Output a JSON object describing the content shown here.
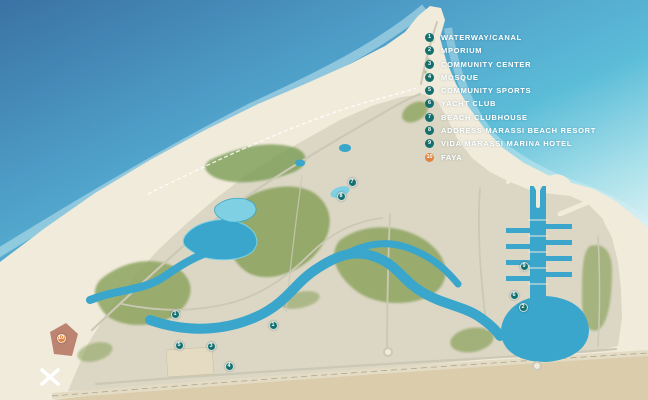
{
  "app": {
    "name": "marassi-master-plan-map"
  },
  "legend": {
    "items": [
      {
        "number": "1",
        "label": "WATERWAY/CANAL"
      },
      {
        "number": "2",
        "label": "MPORIUM"
      },
      {
        "number": "3",
        "label": "COMMUNITY CENTER"
      },
      {
        "number": "4",
        "label": "MOSQUE"
      },
      {
        "number": "5",
        "label": "COMMUNITY SPORTS"
      },
      {
        "number": "6",
        "label": "YACHT CLUB"
      },
      {
        "number": "7",
        "label": "BEACH CLUBHOUSE"
      },
      {
        "number": "8",
        "label": "ADDRESS MARASSI BEACH RESORT"
      },
      {
        "number": "9",
        "label": "VIDA MARASSI MARINA HOTEL"
      },
      {
        "number": "10",
        "label": "FAYA",
        "accent": true
      }
    ]
  },
  "map": {
    "markers": [
      {
        "number": "1",
        "x": 175,
        "y": 314
      },
      {
        "number": "1",
        "x": 273,
        "y": 325
      },
      {
        "number": "5",
        "x": 179,
        "y": 345
      },
      {
        "number": "3",
        "x": 211,
        "y": 346
      },
      {
        "number": "4",
        "x": 229,
        "y": 366
      },
      {
        "number": "10",
        "x": 61,
        "y": 338,
        "accent": true
      },
      {
        "number": "7",
        "x": 352,
        "y": 182
      },
      {
        "number": "8",
        "x": 341,
        "y": 196
      },
      {
        "number": "9",
        "x": 524,
        "y": 266
      },
      {
        "number": "6",
        "x": 514,
        "y": 295
      },
      {
        "number": "2",
        "x": 523,
        "y": 307
      }
    ],
    "colors": {
      "sea_deep": "#3a72a4",
      "sea_mid": "#4e9ec8",
      "sea_turquoise": "#5cbdd8",
      "sea_pale": "#a8e0ea",
      "foam": "#d9f1f4",
      "sand": "#f1ebdc",
      "land": "#dcd7c5",
      "land_texture": "#8f9183",
      "greenery": "#8da45f",
      "greenery_dark": "#74984e",
      "lagoon": "#3aa6cc",
      "lagoon_light": "#7fd0e2",
      "terracotta": "#b97f6a",
      "road": "#ccc8b6",
      "highway": "#e3dbc4",
      "desert": "#dbcdac",
      "marker": "#13706e",
      "marker_accent": "#df8440",
      "marker_text": "#ffffff"
    }
  }
}
